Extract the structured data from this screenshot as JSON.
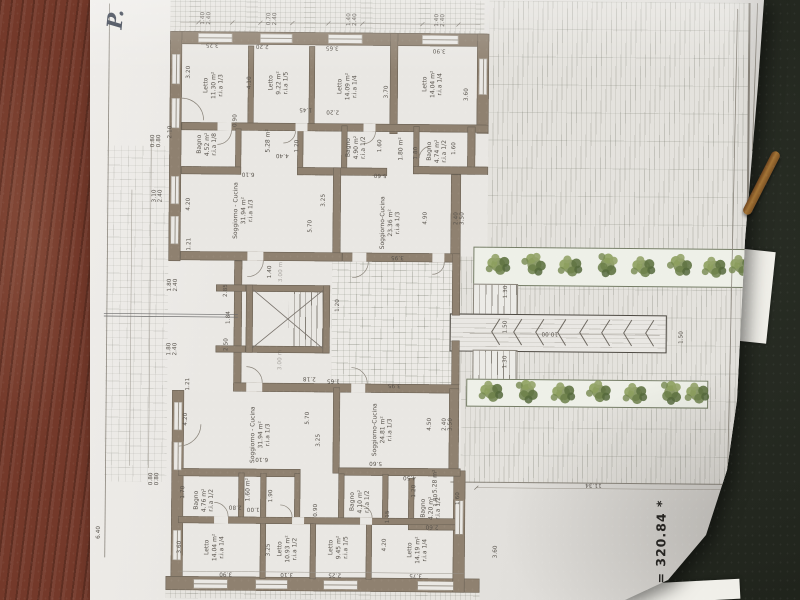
{
  "annotations": {
    "handwritten_note": "P.",
    "scale_note": "SC = 320.84 *"
  },
  "rooms": {
    "u_letto_1130": {
      "name": "Letto",
      "area": "11.30 m²",
      "ria": "r.i.a 1/3"
    },
    "u_letto_922": {
      "name": "Letto",
      "area": "9.22 m²",
      "ria": "r.i.a 1/5"
    },
    "u_letto_1409": {
      "name": "Letto",
      "area": "14.09 m²",
      "ria": "r.i.a 1/4"
    },
    "u_letto_1404": {
      "name": "Letto",
      "area": "14.04 m²",
      "ria": "r.i.a 1/4"
    },
    "u_bagno_452": {
      "name": "Bagno",
      "area": "4.52 m²",
      "ria": "r.i.a 1/8"
    },
    "u_hall": {
      "area": "5.28 m²"
    },
    "u_bagno_490": {
      "name": "Bagno",
      "area": "4.90 m²",
      "ria": "r.i.a 1/2"
    },
    "u_closet": {
      "area": "1.80 m²"
    },
    "u_bagno_474": {
      "name": "Bagno",
      "area": "4.74 m²",
      "ria": "r.i.a 1/2"
    },
    "u_sogg_3194": {
      "name": "Soggiorno - Cucina",
      "area": "31.94 m²",
      "ria": "r.i.a 1/3"
    },
    "u_sogg_2336": {
      "name": "Soggiorno-Cucina",
      "area": "23.36 m²",
      "ria": "r.i.a 1/3"
    },
    "l_sogg_3194": {
      "name": "Soggiorno - Cucina",
      "area": "31.94 m²",
      "ria": "r.i.a 1/3"
    },
    "l_sogg_2481": {
      "name": "Soggiorno-Cucina",
      "area": "24.81 m²",
      "ria": "r.i.a 1/3"
    },
    "l_bagno_476": {
      "name": "Bagno",
      "area": "4.76 m²",
      "ria": "r.i.a 1/2"
    },
    "l_closet": {
      "area": "1.60 m²"
    },
    "l_bagno_410": {
      "name": "Bagno",
      "area": "4.10 m²",
      "ria": "r.i.a 1/2"
    },
    "l_hall": {
      "area": "5.28 m²"
    },
    "l_bagno_420": {
      "name": "Bagno",
      "area": "4.20 m²",
      "ria": "r.i.a 1/2"
    },
    "l_letto_1404": {
      "name": "Letto",
      "area": "14.04 m²",
      "ria": "r.i.a 1/4"
    },
    "l_letto_1093": {
      "name": "Letto",
      "area": "10.93 m²",
      "ria": "r.i.a 1/2"
    },
    "l_letto_945": {
      "name": "Letto",
      "area": "9.45 m²",
      "ria": "r.i.a 1/5"
    },
    "l_letto_1419": {
      "name": "Letto",
      "area": "14.19 m²",
      "ria": "r.i.a 1/4"
    }
  },
  "dims": [
    "1.40\n2.40",
    "0.70\n2.40",
    "1.40\n2.40",
    "1.40\n2.40",
    "3.25",
    "2.20",
    "3.65",
    "3.90",
    "3.20",
    "4.10",
    "3.70",
    "3.60",
    "2.10",
    "0.90",
    "1.45",
    "2.20",
    "1.20",
    "1.60",
    "1.80",
    "1.60",
    "0.80\n0.80",
    "5.60",
    "6.10",
    "4.40",
    "4.20",
    "3.10\n2.40",
    "3.25",
    "5.70",
    "4.90",
    "2.40\n3.50",
    "3.95",
    "1.30",
    "1.50",
    "10.00",
    "1.30",
    "1.50",
    "1.40",
    "1.20",
    "2.85",
    "1.84",
    "2.50",
    "2.18",
    "1.65",
    "3.95",
    "1.21",
    "1.80\n2.40",
    "1.80\n2.40",
    "1.21",
    "4.20",
    "6.10",
    "5.70",
    "3.25",
    "4.50",
    "2.40\n3.50",
    "5.60",
    "1.90",
    "2.80",
    "1.00",
    "4.50",
    "1.20",
    "1.80",
    "1.60",
    "0.90",
    "1.70",
    "0.80\n0.80",
    "3.60",
    "3.25",
    "4.20",
    "3.90",
    "3.10",
    "2.25",
    "3.75",
    "3.60",
    "11.34",
    "6.40",
    "1.15",
    "2.60",
    "3.00 m",
    "3.00 m"
  ],
  "colors": {
    "wall": "#8f8170",
    "paper": "#e7e5e1",
    "plant_green": "#7a8c52",
    "wood_desk": "#74392a",
    "dark_desk": "#23271f"
  }
}
